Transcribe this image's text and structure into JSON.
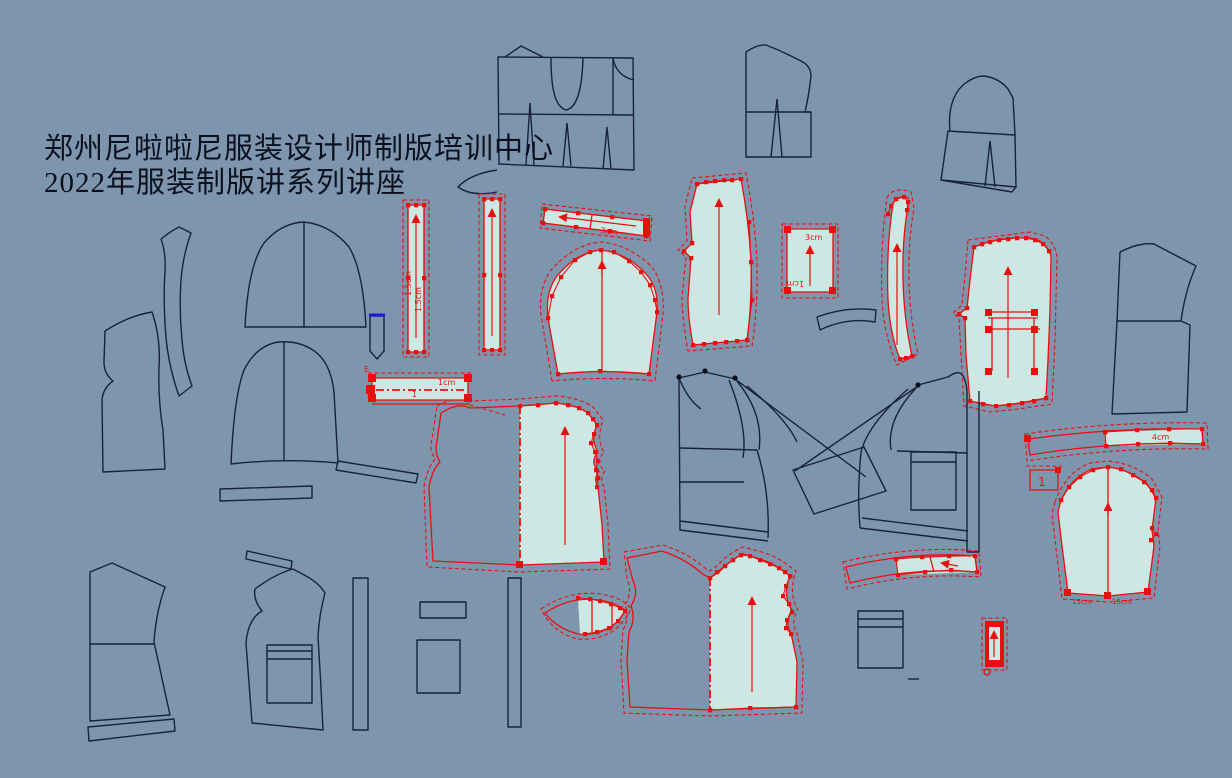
{
  "app": {
    "name": "garment-pattern-cad-canvas"
  },
  "colors": {
    "bg": "#7E95AE",
    "navy": "#17233D",
    "red": "#E8100F",
    "teal": "#CDE7E2",
    "blue": "#1A1AE0",
    "ink": "#0A0F1E"
  },
  "header": {
    "line1": "郑州尼啦啦尼服装设计师制版培训中心",
    "line2": "2022年服装制版讲系列讲座"
  },
  "labels": {
    "strip_a_1": "1.5cm",
    "strip_a_2": "1.5cm",
    "angled_strip": "3cm",
    "square_top": "3cm",
    "square_bottom": "1cm",
    "band_e": "E",
    "band_width": "1cm",
    "band_num": "1",
    "long_strip": "4cm",
    "sleeve_tag": "1",
    "sleeve_b1": "15cm",
    "sleeve_b2": "15cm"
  }
}
